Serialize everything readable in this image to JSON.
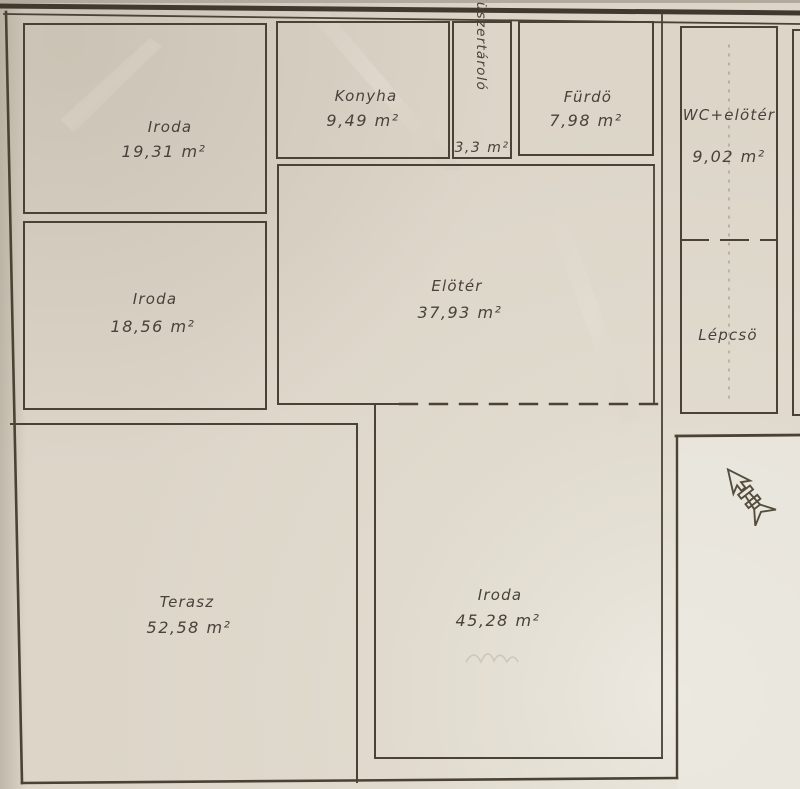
{
  "document": {
    "kind": "scanned floor plan",
    "language": "Hungarian"
  },
  "colors": {
    "paper": "#dcd5c8",
    "paper_bright": "#ece9e1",
    "ink_wall": "#4a4234",
    "ink_text": "#49423a"
  },
  "icons": {
    "north_arrow": "north-arrow"
  },
  "rooms": [
    {
      "id": "iroda-1",
      "name": "Iroda",
      "area": "19,31 m²"
    },
    {
      "id": "iroda-2",
      "name": "Iroda",
      "area": "18,56 m²"
    },
    {
      "id": "konyha",
      "name": "Konyha",
      "area": "9,49 m²"
    },
    {
      "id": "muszertarolo",
      "name": "Müszertároló",
      "area": "3,3 m²"
    },
    {
      "id": "furdo",
      "name": "Fürdö",
      "area": "7,98 m²"
    },
    {
      "id": "wc-eloter",
      "name": "WC+elötér",
      "area": "9,02 m²"
    },
    {
      "id": "eloter",
      "name": "Elötér",
      "area": "37,93 m²"
    },
    {
      "id": "lepcso",
      "name": "Lépcsö",
      "area": ""
    },
    {
      "id": "terasz",
      "name": "Terasz",
      "area": "52,58 m²"
    },
    {
      "id": "iroda-3",
      "name": "Iroda",
      "area": "45,28 m²"
    }
  ]
}
